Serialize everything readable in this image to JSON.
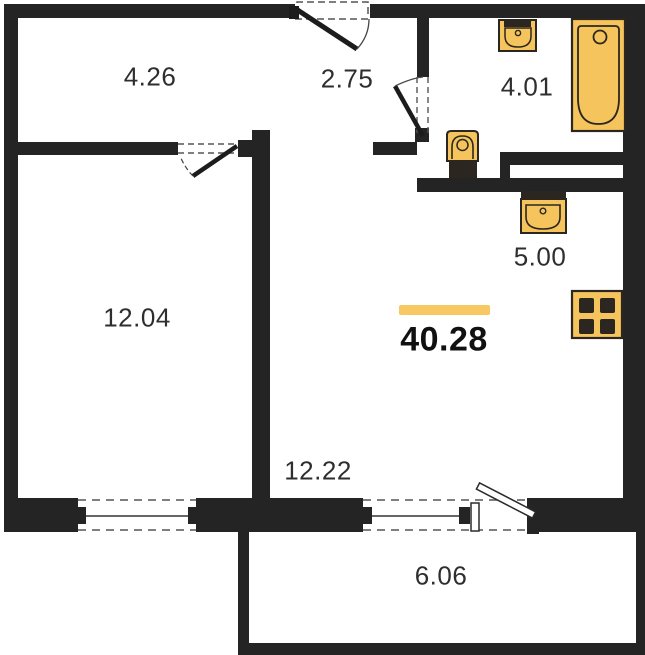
{
  "plan": {
    "type": "apartment-floor-plan",
    "total_area": "40.28",
    "rooms": {
      "hall": {
        "name": "hallway-top-left",
        "area": "4.26"
      },
      "entry": {
        "name": "entry-hall",
        "area": "2.75"
      },
      "bathroom": {
        "name": "bathroom",
        "area": "4.01"
      },
      "bedroom": {
        "name": "bedroom",
        "area": "12.04"
      },
      "kitchen": {
        "name": "kitchen-zone",
        "area": "5.00"
      },
      "living": {
        "name": "living-room",
        "area": "12.22"
      },
      "balcony": {
        "name": "balcony",
        "area": "6.06"
      }
    },
    "fixtures": [
      "bathtub",
      "washbasin",
      "toilet",
      "kitchen-sink",
      "stove"
    ],
    "colors": {
      "wall": "#242424",
      "fixture_fill": "#F5C45C",
      "fixture_stroke": "#2B2620",
      "accent_bar": "#F8C863",
      "label_text": "#2E2E2E",
      "total_text": "#111111"
    }
  }
}
